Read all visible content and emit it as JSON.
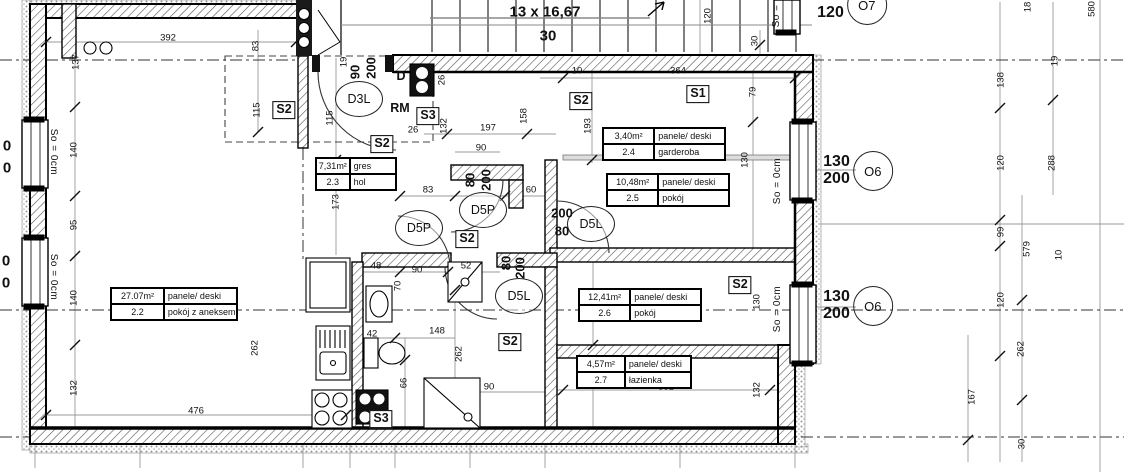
{
  "stairs": {
    "treads_label": "13 x 16,67",
    "rise_label": "30"
  },
  "rooms": [
    {
      "area": "27.07m²",
      "floor": "panele/ deski",
      "num": "2.2",
      "name": "pokój z aneksem",
      "x": 110,
      "y": 287,
      "w": 126
    },
    {
      "area": "7,31m²",
      "floor": "gres",
      "num": "2.3",
      "name": "hol",
      "x": 315,
      "y": 157,
      "w": 80
    },
    {
      "area": "3,40m²",
      "floor": "panele/ deski",
      "num": "2.4",
      "name": "garderoba",
      "x": 602,
      "y": 127,
      "w": 122
    },
    {
      "area": "10,48m²",
      "floor": "panele/ deski",
      "num": "2.5",
      "name": "pokój",
      "x": 606,
      "y": 173,
      "w": 122
    },
    {
      "area": "12,41m²",
      "floor": "panele/ deski",
      "num": "2.6",
      "name": "pokój",
      "x": 578,
      "y": 288,
      "w": 122
    },
    {
      "area": "4,57m²",
      "floor": "panele/ deski",
      "num": "2.7",
      "name": "łazienka",
      "x": 576,
      "y": 355,
      "w": 114
    }
  ],
  "vents": [
    {
      "t": "S2",
      "x": 284,
      "y": 110
    },
    {
      "t": "S3",
      "x": 428,
      "y": 116
    },
    {
      "t": "S2",
      "x": 382,
      "y": 144
    },
    {
      "t": "S2",
      "x": 581,
      "y": 101
    },
    {
      "t": "S1",
      "x": 698,
      "y": 94
    },
    {
      "t": "S2",
      "x": 467,
      "y": 239
    },
    {
      "t": "S2",
      "x": 510,
      "y": 342
    },
    {
      "t": "S2",
      "x": 740,
      "y": 285
    },
    {
      "t": "S3",
      "x": 381,
      "y": 419
    }
  ],
  "doors": [
    {
      "t": "D3L",
      "x": 359,
      "y": 99
    },
    {
      "t": "D5P",
      "x": 483,
      "y": 210
    },
    {
      "t": "D5P",
      "x": 419,
      "y": 228
    },
    {
      "t": "D5L",
      "x": 591,
      "y": 224
    },
    {
      "t": "D5L",
      "x": 519,
      "y": 296
    }
  ],
  "window_labels": [
    {
      "l1": "130",
      "l2": "200",
      "c": "O6",
      "x": 858,
      "y": 171
    },
    {
      "l1": "130",
      "l2": "200",
      "c": "O6",
      "x": 858,
      "y": 306
    },
    {
      "l1": "120",
      "l2": "120",
      "c": "O7",
      "x": 852,
      "y": 5
    }
  ],
  "sills": [
    {
      "t": "So = 0cm",
      "x": 53,
      "y": 152,
      "c": "v2 sill"
    },
    {
      "t": "So = 0cm",
      "x": 53,
      "y": 277,
      "c": "v2 sill"
    },
    {
      "t": "So = 0cm",
      "x": 778,
      "y": 181,
      "c": "v sill"
    },
    {
      "t": "So = 0cm",
      "x": 778,
      "y": 309,
      "c": "v sill"
    },
    {
      "t": "So =",
      "x": 777,
      "y": 16,
      "c": "v sill"
    }
  ],
  "letters": [
    {
      "t": "D",
      "x": 401,
      "y": 76,
      "c": "md"
    },
    {
      "t": "RM",
      "x": 400,
      "y": 108,
      "c": "md"
    }
  ],
  "window_partials": [
    {
      "t": "0",
      "x": 7,
      "y": 146,
      "c": "pz"
    },
    {
      "t": "0",
      "x": 7,
      "y": 168,
      "c": "pz"
    },
    {
      "t": "0",
      "x": 6,
      "y": 261,
      "c": "pz"
    },
    {
      "t": "0",
      "x": 6,
      "y": 283,
      "c": "pz"
    }
  ],
  "dims": [
    {
      "t": "392",
      "x": 168,
      "y": 38
    },
    {
      "t": "476",
      "x": 196,
      "y": 411
    },
    {
      "t": "197",
      "x": 488,
      "y": 128
    },
    {
      "t": "90",
      "x": 481,
      "y": 148
    },
    {
      "t": "83",
      "x": 428,
      "y": 190
    },
    {
      "t": "60",
      "x": 531,
      "y": 190
    },
    {
      "t": "10",
      "x": 577,
      "y": 71
    },
    {
      "t": "364",
      "x": 678,
      "y": 71
    },
    {
      "t": "26",
      "x": 413,
      "y": 130
    },
    {
      "t": "48",
      "x": 376,
      "y": 266
    },
    {
      "t": "52",
      "x": 466,
      "y": 266
    },
    {
      "t": "90",
      "x": 417,
      "y": 270
    },
    {
      "t": "42",
      "x": 372,
      "y": 334
    },
    {
      "t": "148",
      "x": 437,
      "y": 331
    },
    {
      "t": "90",
      "x": 489,
      "y": 387
    },
    {
      "t": "381",
      "x": 666,
      "y": 387
    },
    {
      "t": "83",
      "x": 256,
      "y": 46,
      "c": "v"
    },
    {
      "t": "115",
      "x": 257,
      "y": 110,
      "c": "v"
    },
    {
      "t": "115",
      "x": 330,
      "y": 118,
      "c": "v"
    },
    {
      "t": "173",
      "x": 336,
      "y": 202,
      "c": "v"
    },
    {
      "t": "137",
      "x": 76,
      "y": 62,
      "c": "v"
    },
    {
      "t": "140",
      "x": 74,
      "y": 150,
      "c": "v"
    },
    {
      "t": "95",
      "x": 74,
      "y": 225,
      "c": "v"
    },
    {
      "t": "140",
      "x": 74,
      "y": 298,
      "c": "v"
    },
    {
      "t": "132",
      "x": 74,
      "y": 388,
      "c": "v"
    },
    {
      "t": "262",
      "x": 255,
      "y": 348,
      "c": "v"
    },
    {
      "t": "19",
      "x": 344,
      "y": 62,
      "c": "v"
    },
    {
      "t": "26",
      "x": 442,
      "y": 80,
      "c": "v"
    },
    {
      "t": "132",
      "x": 444,
      "y": 126,
      "c": "v"
    },
    {
      "t": "158",
      "x": 524,
      "y": 116,
      "c": "v"
    },
    {
      "t": "193",
      "x": 588,
      "y": 126,
      "c": "v"
    },
    {
      "t": "79",
      "x": 753,
      "y": 92,
      "c": "v"
    },
    {
      "t": "130",
      "x": 745,
      "y": 160,
      "c": "v"
    },
    {
      "t": "130",
      "x": 757,
      "y": 302,
      "c": "v"
    },
    {
      "t": "132",
      "x": 757,
      "y": 390,
      "c": "v"
    },
    {
      "t": "70",
      "x": 398,
      "y": 286,
      "c": "v"
    },
    {
      "t": "66",
      "x": 404,
      "y": 383,
      "c": "v"
    },
    {
      "t": "262",
      "x": 459,
      "y": 354,
      "c": "v"
    },
    {
      "t": "120",
      "x": 708,
      "y": 16,
      "c": "v"
    },
    {
      "t": "30",
      "x": 755,
      "y": 41,
      "c": "v"
    },
    {
      "t": "138",
      "x": 1001,
      "y": 80,
      "c": "v"
    },
    {
      "t": "18",
      "x": 1028,
      "y": 7,
      "c": "v"
    },
    {
      "t": "19",
      "x": 1055,
      "y": 61,
      "c": "v"
    },
    {
      "t": "580",
      "x": 1092,
      "y": 9,
      "c": "v"
    },
    {
      "t": "120",
      "x": 1001,
      "y": 163,
      "c": "v"
    },
    {
      "t": "99",
      "x": 1001,
      "y": 232,
      "c": "v"
    },
    {
      "t": "120",
      "x": 1001,
      "y": 300,
      "c": "v"
    },
    {
      "t": "288",
      "x": 1052,
      "y": 163,
      "c": "v"
    },
    {
      "t": "579",
      "x": 1027,
      "y": 249,
      "c": "v"
    },
    {
      "t": "10",
      "x": 1059,
      "y": 255,
      "c": "v"
    },
    {
      "t": "167",
      "x": 972,
      "y": 397,
      "c": "v"
    },
    {
      "t": "262",
      "x": 1021,
      "y": 349,
      "c": "v"
    },
    {
      "t": "30",
      "x": 1022,
      "y": 444,
      "c": "v"
    },
    {
      "t": "90",
      "x": 355,
      "y": 72,
      "c": "v xl"
    },
    {
      "t": "200",
      "x": 371,
      "y": 68,
      "c": "v xl"
    },
    {
      "t": "80",
      "x": 470,
      "y": 180,
      "c": "v xl"
    },
    {
      "t": "200",
      "x": 486,
      "y": 180,
      "c": "v xl"
    },
    {
      "t": "80",
      "x": 506,
      "y": 263,
      "c": "v xl"
    },
    {
      "t": "200",
      "x": 520,
      "y": 268,
      "c": "v xl"
    },
    {
      "t": "200",
      "x": 562,
      "y": 213,
      "c": "xl"
    },
    {
      "t": "80",
      "x": 562,
      "y": 231,
      "c": "xl"
    }
  ]
}
